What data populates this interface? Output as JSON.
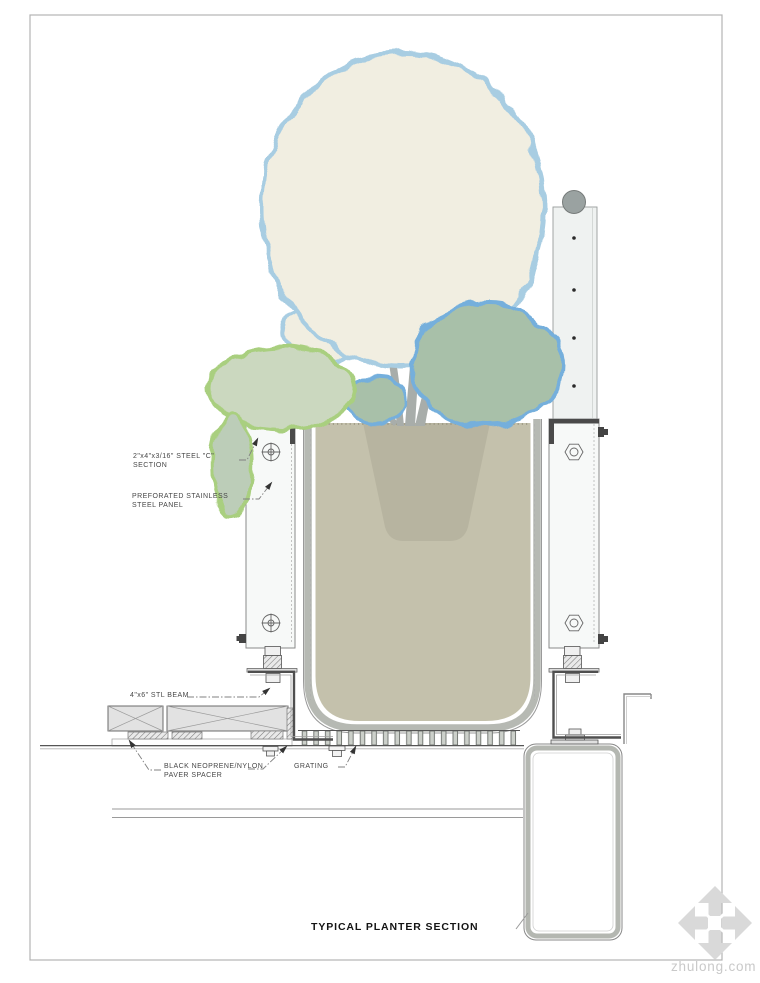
{
  "title": "TYPICAL PLANTER SECTION",
  "watermark": {
    "text": "zhulong.com"
  },
  "annotations": {
    "steel_c_section": {
      "text": "2\"x4\"x3/16\" STEEL \"C\"\nSECTION"
    },
    "stainless_panel": {
      "text": "PREFORATED STAINLESS\nSTEEL PANEL"
    },
    "steel_beam": {
      "text": "4\"x6\" STL BEAM"
    },
    "paver_spacer": {
      "text": "BLACK NEOPRENE/NYLON\nPAVER SPACER"
    },
    "grating": {
      "text": "GRATING"
    }
  },
  "colors": {
    "canopy_fill": "#f1eee1",
    "canopy_stroke": "#a8cde2",
    "foliage_sage_fill": "#a8c0a9",
    "foliage_blue_stroke": "#74afdc",
    "foliage_pale_fill": "#cbd8bf",
    "foliage_green_stroke": "#a9cf7f",
    "trunk_gray": "#a8adaa",
    "soil_tan": "#c4c1ac",
    "rootball_tan": "#b7b4a0",
    "planter_band_gray": "#b6b9b3",
    "panel_fill": "#f7f9f8",
    "post_fill": "#eff2f1",
    "rail_cap_gray": "#9aa2a1",
    "line_dark": "#4f4f4f",
    "leader_gray": "#808080",
    "watermark_gray": "#d9d9d9"
  }
}
